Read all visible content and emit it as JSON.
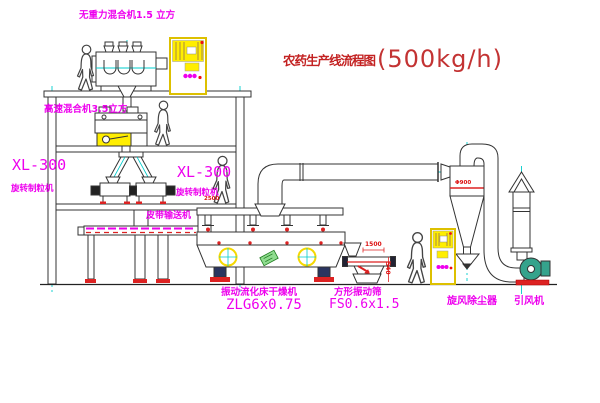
{
  "title": {
    "text": "农药生产线流程图",
    "capacity": "(500kg/h)"
  },
  "equipment_labels": {
    "zero_gravity_mixer": "无重力混合机1.5 立方",
    "high_speed_mixer": "高速混合机3.5立方",
    "granulator_left_model": "XL-300",
    "granulator_left_name": "旋转制粒机",
    "granulator_mid_model": "XL-300",
    "granulator_mid_name": "旋转制粒机",
    "belt_conveyor": "皮带输送机",
    "dryer_name": "振动流化床干燥机",
    "dryer_model": "ZLG6x0.75",
    "screen_name": "方形振动筛",
    "screen_model": "FS0.6x1.5",
    "cyclone_name": "旋风除尘器",
    "fan_name": "引风机"
  },
  "dimensions": {
    "dryer_feed": "2500",
    "screen_length": "1500",
    "screen_height": "540",
    "cyclone_marking": "Φ900"
  },
  "colors": {
    "label_magenta": "#ee00ee",
    "title_red": "#c32222",
    "dimension_red": "#dd1111",
    "cabinet_yellow": "#ffee00",
    "centerline_cyan": "#00cccc",
    "line_dark": "#333333",
    "fan_green": "#35a38c"
  }
}
